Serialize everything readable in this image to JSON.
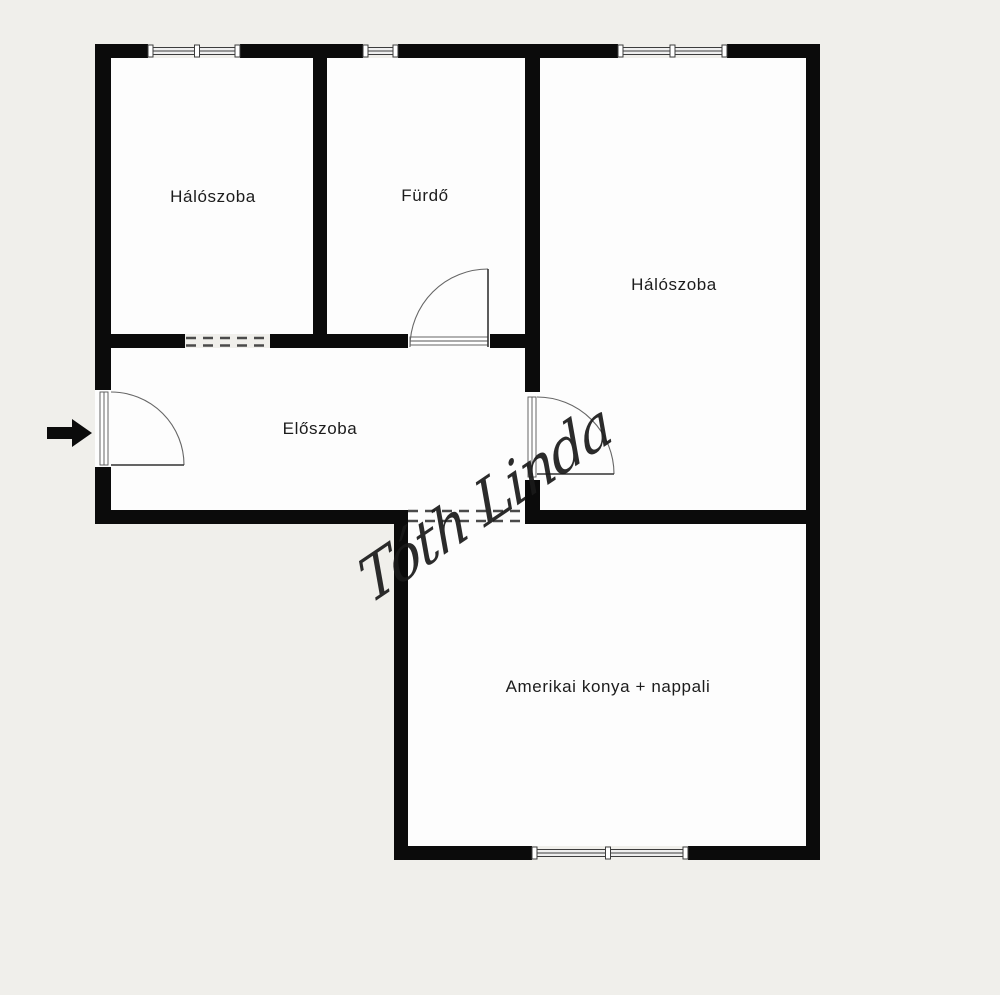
{
  "rooms": [
    {
      "id": "bedroom-1",
      "label": "Hálószoba"
    },
    {
      "id": "bathroom",
      "label": "Fürdő"
    },
    {
      "id": "bedroom-2",
      "label": "Hálószoba"
    },
    {
      "id": "hallway",
      "label": "Előszoba"
    },
    {
      "id": "living-kitchen",
      "label": "Amerikai konya + nappali"
    }
  ],
  "watermark": {
    "text": "Tóth Linda"
  },
  "entrance": {
    "icon": "entrance-arrow",
    "direction": "right"
  },
  "colors": {
    "background": "#f0efeb",
    "wall": "#0b0b0b",
    "room": "#fdfdfd",
    "line": "#4a4a4a",
    "text": "#1c1c1c"
  }
}
